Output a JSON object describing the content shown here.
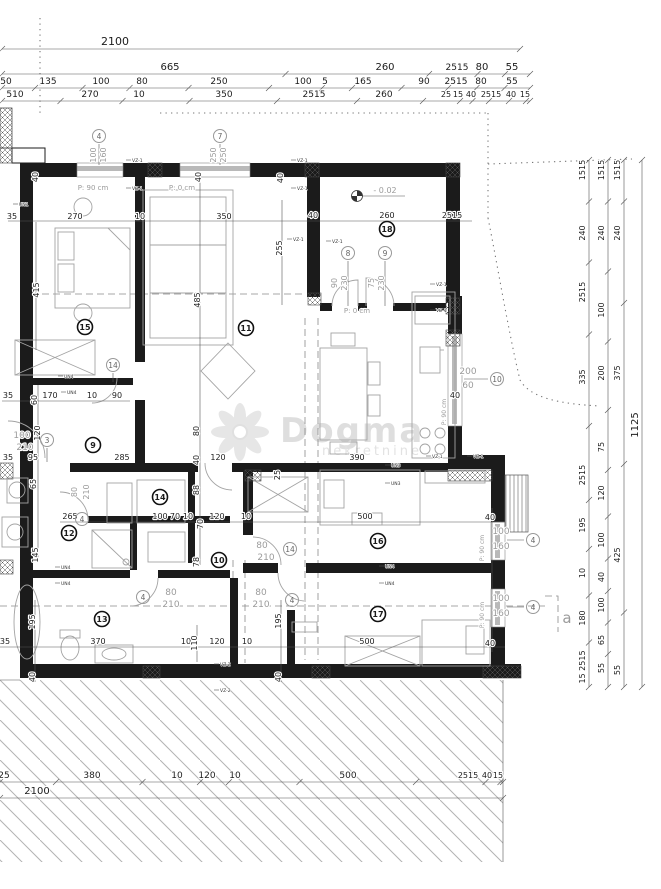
{
  "watermark": {
    "brand": "Dogma",
    "sub": "nekretnine"
  },
  "level_marker": {
    "value": "- 0.02"
  },
  "section_label": "a",
  "dims": {
    "rows": [
      {
        "y": 45,
        "x1": 2,
        "x2": 520,
        "labels": [
          {
            "x": 115,
            "t": "2100",
            "s": 11
          }
        ]
      },
      {
        "y": 70,
        "x1": 2,
        "x2": 530,
        "labels": [
          {
            "x": 170,
            "t": "665",
            "s": 10
          },
          {
            "x": 385,
            "t": "260",
            "s": 10
          },
          {
            "x": 457,
            "t": "2515",
            "s": 9
          },
          {
            "x": 482,
            "t": "80",
            "s": 10
          },
          {
            "x": 512,
            "t": "55",
            "s": 10
          }
        ]
      },
      {
        "y": 84,
        "x1": 2,
        "x2": 530,
        "labels": [
          {
            "x": 6,
            "t": "50",
            "s": 9
          },
          {
            "x": 48,
            "t": "135",
            "s": 9
          },
          {
            "x": 101,
            "t": "100",
            "s": 9
          },
          {
            "x": 142,
            "t": "80",
            "s": 9
          },
          {
            "x": 219,
            "t": "250",
            "s": 9
          },
          {
            "x": 303,
            "t": "100",
            "s": 9
          },
          {
            "x": 325,
            "t": "5",
            "s": 9
          },
          {
            "x": 363,
            "t": "165",
            "s": 9
          },
          {
            "x": 424,
            "t": "90",
            "s": 9
          },
          {
            "x": 456,
            "t": "2515",
            "s": 9
          },
          {
            "x": 481,
            "t": "80",
            "s": 9
          },
          {
            "x": 512,
            "t": "55",
            "s": 9
          }
        ]
      },
      {
        "y": 97,
        "x1": 2,
        "x2": 530,
        "labels": [
          {
            "x": 15,
            "t": "510",
            "s": 9
          },
          {
            "x": 90,
            "t": "270",
            "s": 9
          },
          {
            "x": 139,
            "t": "10",
            "s": 9
          },
          {
            "x": 224,
            "t": "350",
            "s": 9
          },
          {
            "x": 314,
            "t": "2515",
            "s": 9
          },
          {
            "x": 384,
            "t": "260",
            "s": 9
          },
          {
            "x": 446,
            "t": "25",
            "s": 8
          },
          {
            "x": 458,
            "t": "15",
            "s": 8
          },
          {
            "x": 471,
            "t": "40",
            "s": 8
          },
          {
            "x": 491,
            "t": "2515",
            "s": 8
          },
          {
            "x": 511,
            "t": "40",
            "s": 8
          },
          {
            "x": 525,
            "t": "15",
            "s": 8
          }
        ]
      },
      {
        "y": 778,
        "x1": 0,
        "x2": 503,
        "labels": [
          {
            "x": 4,
            "t": "25",
            "s": 9
          },
          {
            "x": 92,
            "t": "380",
            "s": 9
          },
          {
            "x": 177,
            "t": "10",
            "s": 9
          },
          {
            "x": 207,
            "t": "120",
            "s": 9
          },
          {
            "x": 235,
            "t": "10",
            "s": 9
          },
          {
            "x": 348,
            "t": "500",
            "s": 9
          },
          {
            "x": 468,
            "t": "2515",
            "s": 8
          },
          {
            "x": 487,
            "t": "40",
            "s": 8
          },
          {
            "x": 498,
            "t": "15",
            "s": 8
          }
        ]
      },
      {
        "y": 794,
        "x1": 0,
        "x2": 503,
        "labels": [
          {
            "x": 37,
            "t": "2100",
            "s": 10
          }
        ]
      }
    ],
    "cols": [
      {
        "x": 585,
        "y1": 160,
        "y2": 687,
        "labels": [
          {
            "y": 170,
            "t": "1515"
          },
          {
            "y": 233,
            "t": "240"
          },
          {
            "y": 292,
            "t": "2515"
          },
          {
            "y": 377,
            "t": "335"
          },
          {
            "y": 475,
            "t": "2515"
          },
          {
            "y": 525,
            "t": "195"
          },
          {
            "y": 573,
            "t": "10"
          },
          {
            "y": 618,
            "t": "180"
          },
          {
            "y": 667,
            "t": "15 2515"
          }
        ]
      },
      {
        "x": 604,
        "y1": 160,
        "y2": 687,
        "labels": [
          {
            "y": 170,
            "t": "1515"
          },
          {
            "y": 233,
            "t": "240"
          },
          {
            "y": 310,
            "t": "100"
          },
          {
            "y": 373,
            "t": "200"
          },
          {
            "y": 447,
            "t": "75"
          },
          {
            "y": 493,
            "t": "120"
          },
          {
            "y": 540,
            "t": "100"
          },
          {
            "y": 577,
            "t": "40"
          },
          {
            "y": 605,
            "t": "100"
          },
          {
            "y": 640,
            "t": "65"
          },
          {
            "y": 668,
            "t": "55"
          }
        ]
      },
      {
        "x": 620,
        "y1": 160,
        "y2": 687,
        "labels": [
          {
            "y": 170,
            "t": "1515"
          },
          {
            "y": 233,
            "t": "240"
          },
          {
            "y": 373,
            "t": "375"
          },
          {
            "y": 555,
            "t": "425"
          },
          {
            "y": 670,
            "t": "55"
          }
        ]
      },
      {
        "x": 638,
        "y1": 160,
        "y2": 687,
        "labels": [
          {
            "y": 425,
            "t": "1125",
            "s": 10
          }
        ]
      }
    ],
    "h": [
      {
        "x": 12,
        "y": 219,
        "t": "35"
      },
      {
        "x": 75,
        "y": 219,
        "t": "270"
      },
      {
        "x": 140,
        "y": 219,
        "t": "10"
      },
      {
        "x": 224,
        "y": 219,
        "t": "350"
      },
      {
        "x": 313,
        "y": 218,
        "t": "40"
      },
      {
        "x": 387,
        "y": 218,
        "t": "260"
      },
      {
        "x": 452,
        "y": 218,
        "t": "2515"
      },
      {
        "x": 93,
        "y": 190,
        "t": "P: 90 cm",
        "c": "g",
        "s": 7
      },
      {
        "x": 182,
        "y": 190,
        "t": "P: 0 cm",
        "c": "g",
        "s": 7
      },
      {
        "x": 357,
        "y": 313,
        "t": "P: 0 cm",
        "c": "g",
        "s": 7
      },
      {
        "x": 385,
        "y": 193,
        "t": "- 0.02",
        "c": "g"
      },
      {
        "x": 8,
        "y": 398,
        "t": "35"
      },
      {
        "x": 50,
        "y": 398,
        "t": "170"
      },
      {
        "x": 92,
        "y": 398,
        "t": "10"
      },
      {
        "x": 117,
        "y": 398,
        "t": "90"
      },
      {
        "x": 8,
        "y": 460,
        "t": "35"
      },
      {
        "x": 33,
        "y": 460,
        "t": "95"
      },
      {
        "x": 122,
        "y": 460,
        "t": "285"
      },
      {
        "x": 218,
        "y": 460,
        "t": "120"
      },
      {
        "x": 357,
        "y": 460,
        "t": "390"
      },
      {
        "x": 70,
        "y": 519,
        "t": "265"
      },
      {
        "x": 160,
        "y": 519,
        "t": "100"
      },
      {
        "x": 175,
        "y": 519,
        "t": "70"
      },
      {
        "x": 188,
        "y": 519,
        "t": "10"
      },
      {
        "x": 217,
        "y": 519,
        "t": "120"
      },
      {
        "x": 246,
        "y": 519,
        "t": "10"
      },
      {
        "x": 365,
        "y": 519,
        "t": "500"
      },
      {
        "x": 490,
        "y": 520,
        "t": "40"
      },
      {
        "x": 22,
        "y": 438,
        "t": "100",
        "c": "g",
        "s": 9
      },
      {
        "x": 25,
        "y": 450,
        "t": "210",
        "c": "g",
        "s": 9
      },
      {
        "x": 262,
        "y": 548,
        "t": "80",
        "c": "g",
        "s": 9
      },
      {
        "x": 266,
        "y": 560,
        "t": "210",
        "c": "g",
        "s": 9
      },
      {
        "x": 171,
        "y": 595,
        "t": "80",
        "c": "g",
        "s": 9
      },
      {
        "x": 171,
        "y": 607,
        "t": "210",
        "c": "g",
        "s": 9
      },
      {
        "x": 261,
        "y": 595,
        "t": "80",
        "c": "g",
        "s": 9
      },
      {
        "x": 261,
        "y": 607,
        "t": "210",
        "c": "g",
        "s": 9
      },
      {
        "x": 468,
        "y": 374,
        "t": "200",
        "c": "g",
        "s": 9
      },
      {
        "x": 468,
        "y": 388,
        "t": "60",
        "c": "g",
        "s": 9
      },
      {
        "x": 455,
        "y": 398,
        "t": "40"
      },
      {
        "x": 501,
        "y": 534,
        "t": "100",
        "c": "g",
        "s": 9
      },
      {
        "x": 501,
        "y": 549,
        "t": "160",
        "c": "g",
        "s": 9
      },
      {
        "x": 501,
        "y": 601,
        "t": "100",
        "c": "g",
        "s": 9
      },
      {
        "x": 501,
        "y": 616,
        "t": "160",
        "c": "g",
        "s": 9
      },
      {
        "x": 490,
        "y": 646,
        "t": "40"
      },
      {
        "x": 5,
        "y": 644,
        "t": "35"
      },
      {
        "x": 98,
        "y": 644,
        "t": "370"
      },
      {
        "x": 186,
        "y": 644,
        "t": "10"
      },
      {
        "x": 217,
        "y": 644,
        "t": "120"
      },
      {
        "x": 247,
        "y": 644,
        "t": "10"
      },
      {
        "x": 367,
        "y": 644,
        "t": "500"
      },
      {
        "x": 567,
        "y": 623,
        "t": "a",
        "c": "g",
        "s": 15
      }
    ],
    "v": [
      {
        "x": 38,
        "y": 177,
        "t": "40"
      },
      {
        "x": 201,
        "y": 177,
        "t": "40"
      },
      {
        "x": 283,
        "y": 178,
        "t": "40"
      },
      {
        "x": 96,
        "y": 155,
        "t": "100",
        "c": "g"
      },
      {
        "x": 106,
        "y": 155,
        "t": "160",
        "c": "g"
      },
      {
        "x": 216,
        "y": 155,
        "t": "250",
        "c": "g"
      },
      {
        "x": 226,
        "y": 155,
        "t": "250",
        "c": "g"
      },
      {
        "x": 337,
        "y": 283,
        "t": "90",
        "c": "g"
      },
      {
        "x": 347,
        "y": 283,
        "t": "230",
        "c": "g"
      },
      {
        "x": 374,
        "y": 283,
        "t": "75",
        "c": "g"
      },
      {
        "x": 384,
        "y": 283,
        "t": "230",
        "c": "g"
      },
      {
        "x": 39,
        "y": 290,
        "t": "415"
      },
      {
        "x": 200,
        "y": 300,
        "t": "485"
      },
      {
        "x": 282,
        "y": 248,
        "t": "255"
      },
      {
        "x": 37,
        "y": 400,
        "t": "60"
      },
      {
        "x": 40,
        "y": 433,
        "t": "120"
      },
      {
        "x": 36,
        "y": 484,
        "t": "65"
      },
      {
        "x": 38,
        "y": 555,
        "t": "145"
      },
      {
        "x": 77,
        "y": 492,
        "t": "80",
        "c": "g"
      },
      {
        "x": 89,
        "y": 492,
        "t": "210",
        "c": "g"
      },
      {
        "x": 280,
        "y": 475,
        "t": "25"
      },
      {
        "x": 199,
        "y": 431,
        "t": "80"
      },
      {
        "x": 199,
        "y": 460,
        "t": "40"
      },
      {
        "x": 199,
        "y": 490,
        "t": "88"
      },
      {
        "x": 203,
        "y": 524,
        "t": "70"
      },
      {
        "x": 199,
        "y": 562,
        "t": "78"
      },
      {
        "x": 35,
        "y": 622,
        "t": "195"
      },
      {
        "x": 281,
        "y": 621,
        "t": "195"
      },
      {
        "x": 197,
        "y": 643,
        "t": "110"
      },
      {
        "x": 35,
        "y": 677,
        "t": "40"
      },
      {
        "x": 281,
        "y": 677,
        "t": "40"
      },
      {
        "x": 446,
        "y": 412,
        "t": "P: 90 cm",
        "c": "g",
        "s": 6
      },
      {
        "x": 484,
        "y": 548,
        "t": "P: 90 cm",
        "c": "g",
        "s": 6
      },
      {
        "x": 484,
        "y": 615,
        "t": "P: 90 cm",
        "c": "g",
        "s": 6
      }
    ],
    "wall_tags": [
      {
        "x": 132,
        "y": 162,
        "t": "VZ-1"
      },
      {
        "x": 132,
        "y": 190,
        "t": "VZ-1"
      },
      {
        "x": 297,
        "y": 162,
        "t": "VZ-1"
      },
      {
        "x": 297,
        "y": 190,
        "t": "VZ-1"
      },
      {
        "x": 293,
        "y": 241,
        "t": "VZ-1"
      },
      {
        "x": 332,
        "y": 243,
        "t": "VZ-1"
      },
      {
        "x": 436,
        "y": 286,
        "t": "VZ-1"
      },
      {
        "x": 436,
        "y": 312,
        "t": "VZ-1"
      },
      {
        "x": 432,
        "y": 458,
        "t": "VZ-1"
      },
      {
        "x": 473,
        "y": 458,
        "t": "VZ-1"
      },
      {
        "x": 220,
        "y": 666,
        "t": "VZ-2"
      },
      {
        "x": 220,
        "y": 692,
        "t": "VZ-2"
      },
      {
        "x": 19,
        "y": 206,
        "t": "UN1"
      },
      {
        "x": 64,
        "y": 378,
        "t": "UN4"
      },
      {
        "x": 67,
        "y": 394,
        "t": "UN4"
      },
      {
        "x": 61,
        "y": 569,
        "t": "UN4"
      },
      {
        "x": 61,
        "y": 585,
        "t": "UN4"
      },
      {
        "x": 385,
        "y": 568,
        "t": "UN4"
      },
      {
        "x": 385,
        "y": 585,
        "t": "UN4"
      },
      {
        "x": 391,
        "y": 467,
        "t": "UN3"
      },
      {
        "x": 391,
        "y": 485,
        "t": "UN3"
      }
    ],
    "rooms": [
      {
        "x": 85,
        "y": 327,
        "n": "15"
      },
      {
        "x": 246,
        "y": 328,
        "n": "11"
      },
      {
        "x": 387,
        "y": 229,
        "n": "18"
      },
      {
        "x": 93,
        "y": 445,
        "n": "9"
      },
      {
        "x": 69,
        "y": 533,
        "n": "12"
      },
      {
        "x": 160,
        "y": 497,
        "n": "14"
      },
      {
        "x": 219,
        "y": 560,
        "n": "10"
      },
      {
        "x": 102,
        "y": 619,
        "n": "13"
      },
      {
        "x": 378,
        "y": 541,
        "n": "16"
      },
      {
        "x": 378,
        "y": 614,
        "n": "17"
      }
    ],
    "openings": [
      {
        "x": 99,
        "y": 136,
        "n": "4"
      },
      {
        "x": 220,
        "y": 136,
        "n": "7"
      },
      {
        "x": 348,
        "y": 253,
        "n": "8"
      },
      {
        "x": 385,
        "y": 253,
        "n": "9"
      },
      {
        "x": 47,
        "y": 440,
        "n": "3"
      },
      {
        "x": 82,
        "y": 519,
        "n": "4"
      },
      {
        "x": 113,
        "y": 365,
        "n": "14"
      },
      {
        "x": 290,
        "y": 549,
        "n": "14"
      },
      {
        "x": 143,
        "y": 597,
        "n": "4"
      },
      {
        "x": 292,
        "y": 600,
        "n": "4"
      },
      {
        "x": 497,
        "y": 379,
        "n": "10"
      },
      {
        "x": 533,
        "y": 540,
        "n": "4"
      },
      {
        "x": 533,
        "y": 607,
        "n": "4"
      }
    ]
  }
}
